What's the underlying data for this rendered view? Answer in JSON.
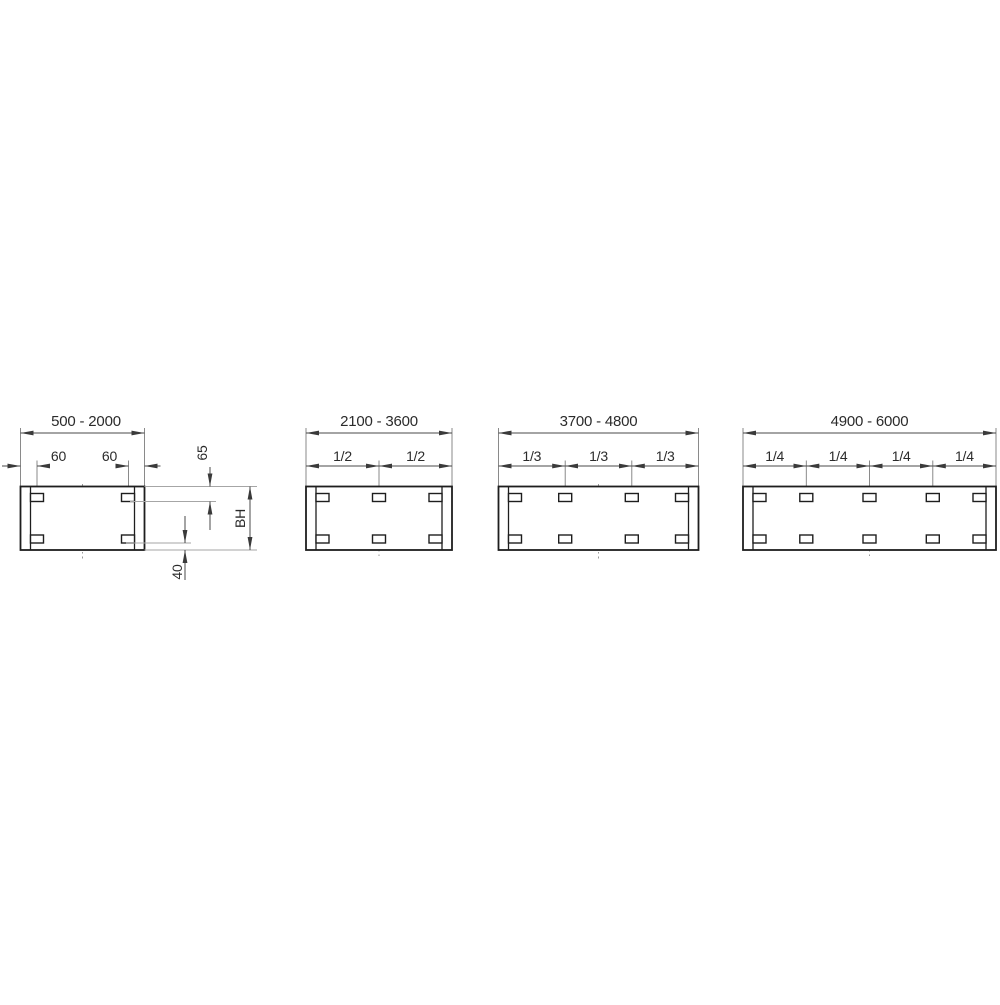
{
  "drawing": {
    "type": "technical-dimension-diagram",
    "background_color": "#ffffff",
    "line_color": "#1e1e1e",
    "dimension_color": "#4a4a4a",
    "panels": [
      {
        "range": "500 - 2000",
        "dims": {
          "left_offset": "60",
          "right_offset": "60",
          "top_slot_offset": "65",
          "body_height": "BH",
          "bottom_slot_offset": "40"
        },
        "slot_columns": 2
      },
      {
        "range": "2100 - 3600",
        "fractions": [
          "1/2",
          "1/2"
        ],
        "slot_columns": 3
      },
      {
        "range": "3700 - 4800",
        "fractions": [
          "1/3",
          "1/3",
          "1/3"
        ],
        "slot_columns": 4
      },
      {
        "range": "4900 - 6000",
        "fractions": [
          "1/4",
          "1/4",
          "1/4",
          "1/4"
        ],
        "slot_columns": 5
      }
    ]
  }
}
